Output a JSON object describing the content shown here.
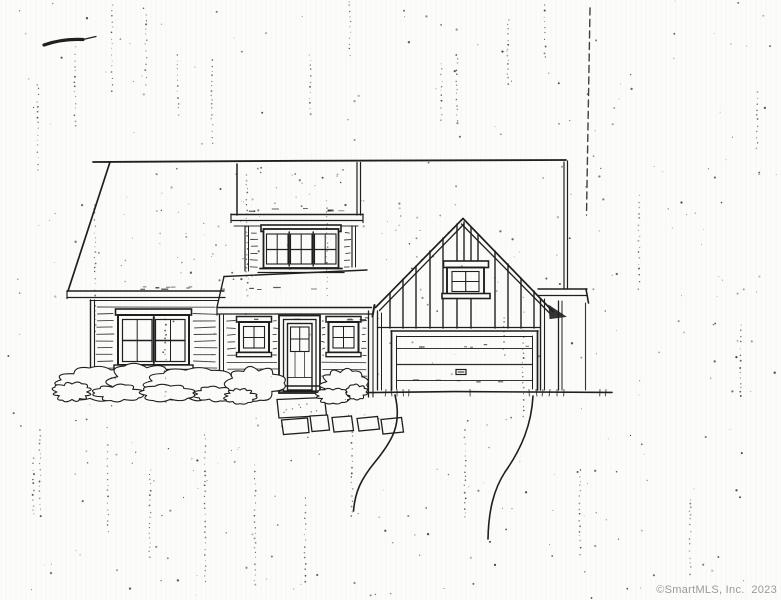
{
  "image": {
    "type": "scanned architectural front-elevation drawing",
    "description": "Black ink line drawing of a two-story house: left wing with clapboard siding and double-hung windows, shed dormer with triple window, center entry porch with glazed door flanked by two small square windows, right gable wing with board-and-batten siding, small four-pane gable window and two-car garage door, shrubs along the foundation, stone pavers and a curving driveway; photocopy speckle noise over the paper"
  },
  "watermark": {
    "text": "©SmartMLS, Inc.  2023",
    "color": "#9a9a9a"
  },
  "colors": {
    "paper": "#fcfcfb",
    "ink": "#1f1f1f",
    "watermark": "#9a9a9a"
  }
}
